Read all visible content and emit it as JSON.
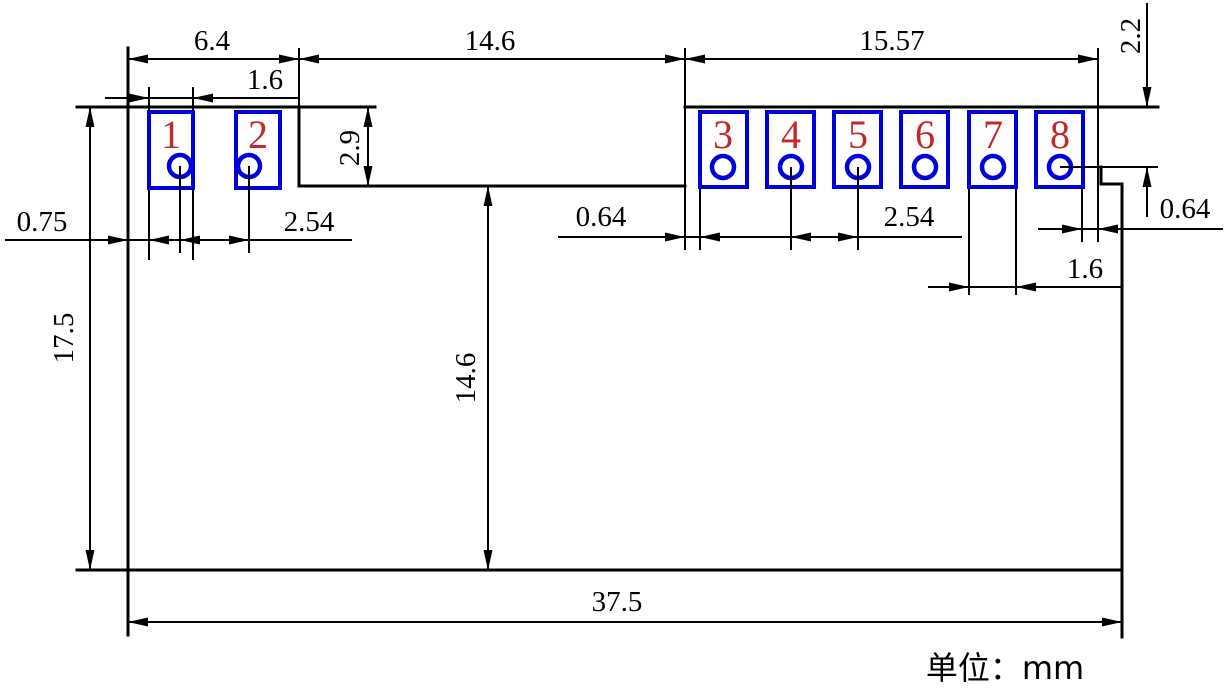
{
  "drawing": {
    "kind": "pcb-footprint-dimension-drawing",
    "units_note": "单位：mm"
  },
  "dimensions": {
    "top_span_left": "6.4",
    "top_span_middle": "14.6",
    "top_span_right": "15.57",
    "pad1_width": "1.6",
    "pad_height": "2.9",
    "top_edge_to_hole_row": "2.2",
    "edge_to_pad1": "0.75",
    "pitch_left": "2.54",
    "edge_to_pad3": "0.64",
    "pitch_right": "2.54",
    "pad8_hole_offset": "0.64",
    "pad7_width": "1.6",
    "body_height": "17.5",
    "notch_depth": "14.6",
    "total_width": "37.5"
  },
  "pads": [
    {
      "label": "1"
    },
    {
      "label": "2"
    },
    {
      "label": "3"
    },
    {
      "label": "4"
    },
    {
      "label": "5"
    },
    {
      "label": "6"
    },
    {
      "label": "7"
    },
    {
      "label": "8"
    }
  ],
  "colors": {
    "line": "#000000",
    "pad_outline": "#0000dd",
    "pad_number": "#c22828",
    "background": "#ffffff"
  }
}
